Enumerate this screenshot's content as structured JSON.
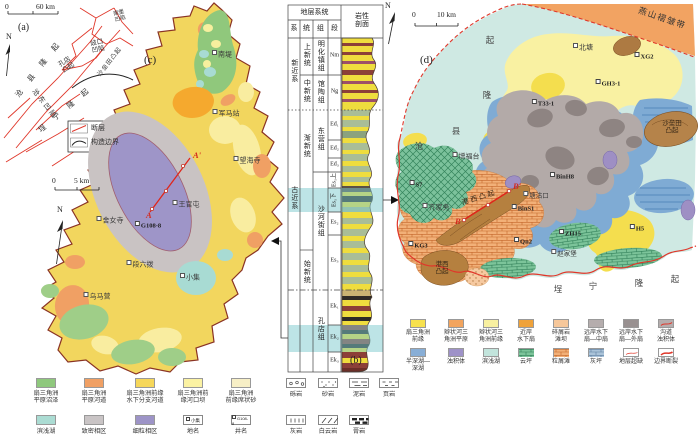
{
  "figure": {
    "panel_a": {
      "tag": "(a)",
      "north": "N",
      "scale_zero": "0",
      "scale_label": "60 km",
      "labels": {
        "nanpu": "南堡凹陷",
        "qikou": "歧口凹陷",
        "shaleitian": "沙垒田凸起",
        "kongdian": "孔店凸起",
        "cangdong": "沧东凹陷",
        "cangxian": "沧县隆起",
        "chengning": "埕宁隆起"
      },
      "legend": {
        "fault": "断层",
        "boundary": "构造边界"
      }
    },
    "panel_c": {
      "tag": "(c)",
      "north": "N",
      "scale_zero": "0",
      "scale_label": "5 km",
      "places": [
        "南堤",
        "军马站",
        "望海寺",
        "王官屯",
        "舍女寺",
        "段六拨",
        "小集",
        "乌马营"
      ],
      "well": "G108-8",
      "section_start": "A",
      "section_end": "A'"
    },
    "panel_b": {
      "tag": "(b)",
      "header": {
        "group": "地层系统",
        "litho": "岩性\n剖面",
        "cols": [
          "系",
          "统",
          "组",
          "段"
        ]
      },
      "systems": [
        "新近系",
        "古近系"
      ],
      "series": [
        "上新统",
        "中新统",
        "渐新统",
        "始新统"
      ],
      "formations": [
        "明化镇组",
        "馆陶组",
        "东营组",
        "沙河街组",
        "孔店组"
      ],
      "members": [
        "Nm",
        "Ng",
        "Ed₁",
        "Ed₂",
        "Ed₃",
        "Es₁上",
        "Es₁下",
        "Es₂",
        "Es₃",
        "Ek₁",
        "Ek₂",
        "Ek₃"
      ]
    },
    "panel_d": {
      "tag": "(d)",
      "north": "N",
      "scale_zero": "0",
      "scale_label": "10 km",
      "edge_labels": {
        "yanshan": "燕山褶皱带",
        "cangxian": [
          "沧",
          "县",
          "隆",
          "起"
        ],
        "chengning": [
          "埕",
          "宁",
          "隆",
          "起"
        ],
        "shaleitian": "沙垒田\n凸起"
      },
      "places": [
        "北塘",
        "增福台",
        "齐家务",
        "塘沽口",
        "赵家堡"
      ],
      "ridge_label": "港西凸起",
      "ridge_label2": "港西\n凸起",
      "wells": [
        "XG2",
        "GH3-1",
        "T33-1",
        "S7",
        "BinH8",
        "BinS1",
        "KG3",
        "Qn2",
        "ZH15",
        "H5"
      ],
      "section_start": "B",
      "section_end": "B'"
    }
  },
  "legend_left": {
    "row1": [
      {
        "label": "扇三角洲\n平原沼泽",
        "color": "#8fc87d"
      },
      {
        "label": "扇三角洲\n平原河道",
        "color": "#f0a064"
      },
      {
        "label": "扇三角洲前缘\n水下分支河道",
        "color": "#f6d75a"
      },
      {
        "label": "扇三角洲前\n缘河口坝",
        "color": "#fbf2a3"
      },
      {
        "label": "扇三角洲\n前缘席状砂",
        "color": "#f7efc6"
      }
    ],
    "row2": [
      {
        "label": "滨浅湖",
        "color": "#abdcd3"
      },
      {
        "label": "致密相区",
        "color": "#c9c4c5"
      },
      {
        "label": "细粒相区",
        "color": "#9d94c7"
      },
      {
        "label": "地名",
        "sample": "小集"
      },
      {
        "label": "井名",
        "sample": "G108-8"
      }
    ]
  },
  "legend_lith": {
    "row1": [
      {
        "label": "砾岩"
      },
      {
        "label": "砂岩"
      },
      {
        "label": "泥岩"
      },
      {
        "label": "页岩"
      }
    ],
    "row2": [
      {
        "label": "灰岩"
      },
      {
        "label": "白云岩"
      },
      {
        "label": "膏岩"
      }
    ]
  },
  "legend_right": {
    "row1": [
      {
        "label": "扇三角洲\n前缘",
        "color": "#f7e14e"
      },
      {
        "label": "辫状河三\n角洲平原",
        "color": "#f2a45e"
      },
      {
        "label": "辫状河三\n角洲前缘",
        "color": "#f8f0a0"
      },
      {
        "label": "近岸\n水下扇",
        "color": "#efa23a"
      },
      {
        "label": "碎屑岩\n滩坝",
        "color": "#f6c79a"
      },
      {
        "label": "远岸水下\n扇—中扇",
        "color": "#b5adad"
      },
      {
        "label": "远岸水下\n扇—外扇",
        "color": "#989090"
      },
      {
        "label": "沟道\n浊积体",
        "color": "#b5adad"
      }
    ],
    "row2": [
      {
        "label": "半深湖—\n深湖",
        "color": "#88aed6"
      },
      {
        "label": "浊积体",
        "color": "#9e92c8"
      },
      {
        "label": "滨浅湖",
        "color": "#c2e4dc"
      },
      {
        "label": "云坪",
        "color": "#7cc49a"
      },
      {
        "label": "粒屑滩",
        "color": "#f0a469"
      },
      {
        "label": "灰坪",
        "color": "#a9bfd6"
      },
      {
        "label": "地层超缺",
        "color": "#e0372a"
      },
      {
        "label": "边界断裂",
        "color": "#e0372a"
      }
    ]
  },
  "colors": {
    "fault_red": "#e0372a",
    "section_red": "#e0251a",
    "map_border": "#8a3324",
    "highlight_band": "#7bc9cd"
  }
}
